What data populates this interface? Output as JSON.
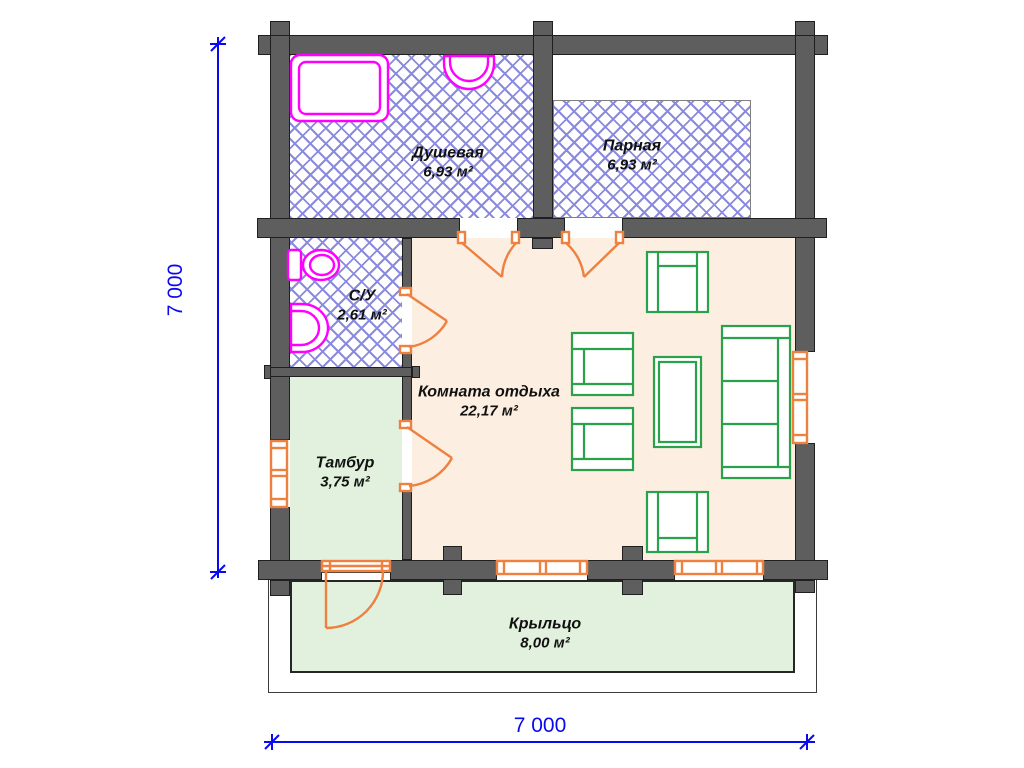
{
  "rooms": [
    {
      "name": "Душевая",
      "area": "6,93 м²"
    },
    {
      "name": "Парная",
      "area": "6,93 м²"
    },
    {
      "name": "С/У",
      "area": "2,61 м²"
    },
    {
      "name": "Комната отдыха",
      "area": "22,17 м²"
    },
    {
      "name": "Тамбур",
      "area": "3,75 м²"
    },
    {
      "name": "Крыльцо",
      "area": "8,00 м²"
    }
  ],
  "dimensions": {
    "overall_width_label": "7 000",
    "overall_height_label": "7 000"
  },
  "colors": {
    "wall": "#5e5e5e",
    "wall_outline": "#1f1f1f",
    "hatch": "#8a8ade",
    "rest_room_fill": "#fcefe1",
    "green_fill": "#e2f1de",
    "furniture": "#2aa24c",
    "plumbing": "#ff00ff",
    "doors_windows": "#ee8040",
    "dimension": "#0a0af0",
    "label_text": "#111111"
  }
}
